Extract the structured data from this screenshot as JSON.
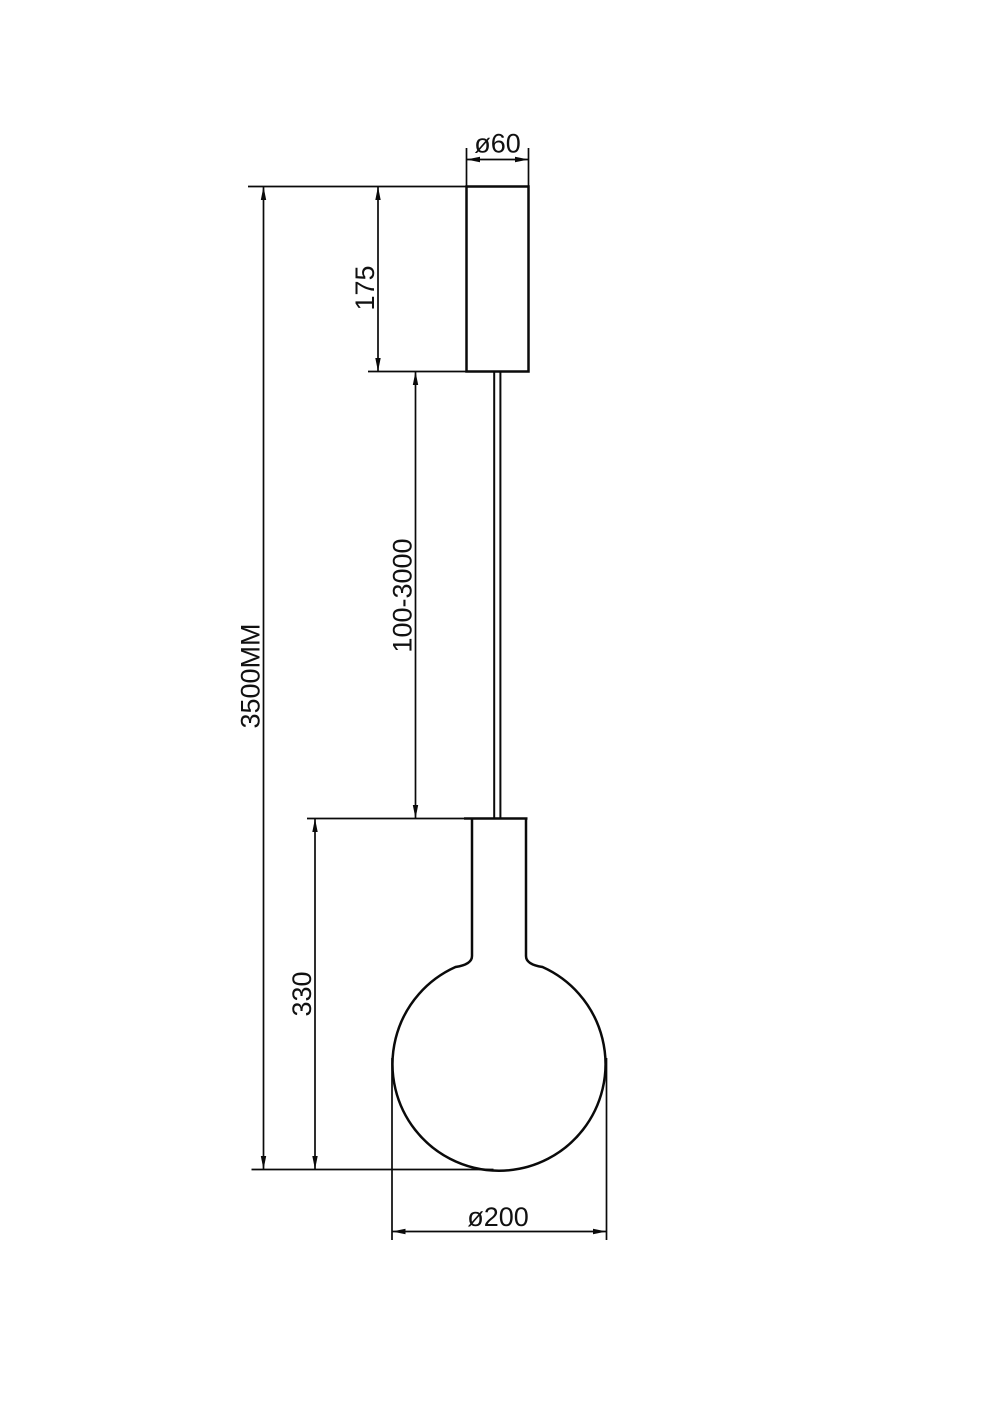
{
  "page": {
    "background": "#ffffff",
    "ink": "#0a0a0a",
    "kind": "technical dimension drawing",
    "subject": "single-globe pendant lamp, front elevation"
  },
  "drawing": {
    "dimensions": {
      "canopy_diameter": "ø60",
      "canopy_height": "175",
      "cable_length": "100-3000",
      "overall_height": "3500MM",
      "lamp_body_height": "330",
      "globe_diameter": "ø200"
    }
  }
}
